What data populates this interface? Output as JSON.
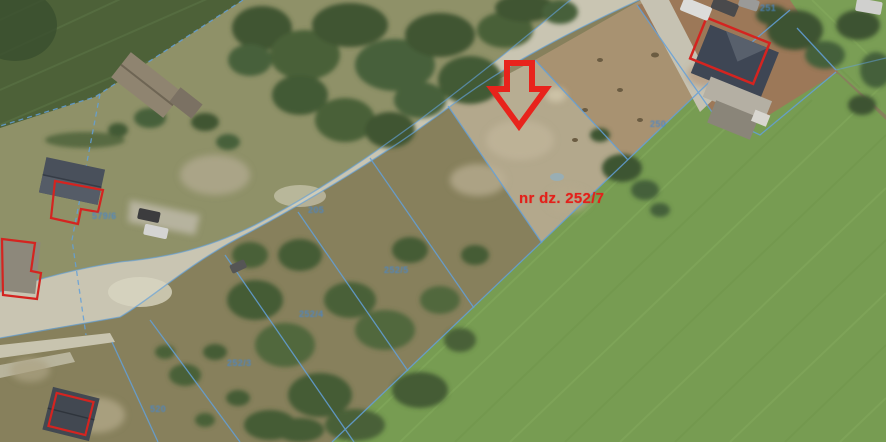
{
  "map": {
    "highlight": {
      "label": "nr dz. 252/7",
      "arrow_color": "#e8231c",
      "label_color": "#e3201a"
    },
    "parcel_labels": [
      {
        "text": "251",
        "x": 760,
        "y": 3
      },
      {
        "text": "250",
        "x": 650,
        "y": 119
      },
      {
        "text": "579/6",
        "x": 92,
        "y": 211
      },
      {
        "text": "205",
        "x": 308,
        "y": 205
      },
      {
        "text": "252/5",
        "x": 384,
        "y": 265
      },
      {
        "text": "252/4",
        "x": 299,
        "y": 309
      },
      {
        "text": "252/3",
        "x": 227,
        "y": 358
      },
      {
        "text": "520",
        "x": 150,
        "y": 404
      }
    ],
    "colors": {
      "boundary_blue": "#63a0da",
      "parcel_label_blue": "#4a86c8",
      "annotation_red": "#e8231c"
    }
  }
}
